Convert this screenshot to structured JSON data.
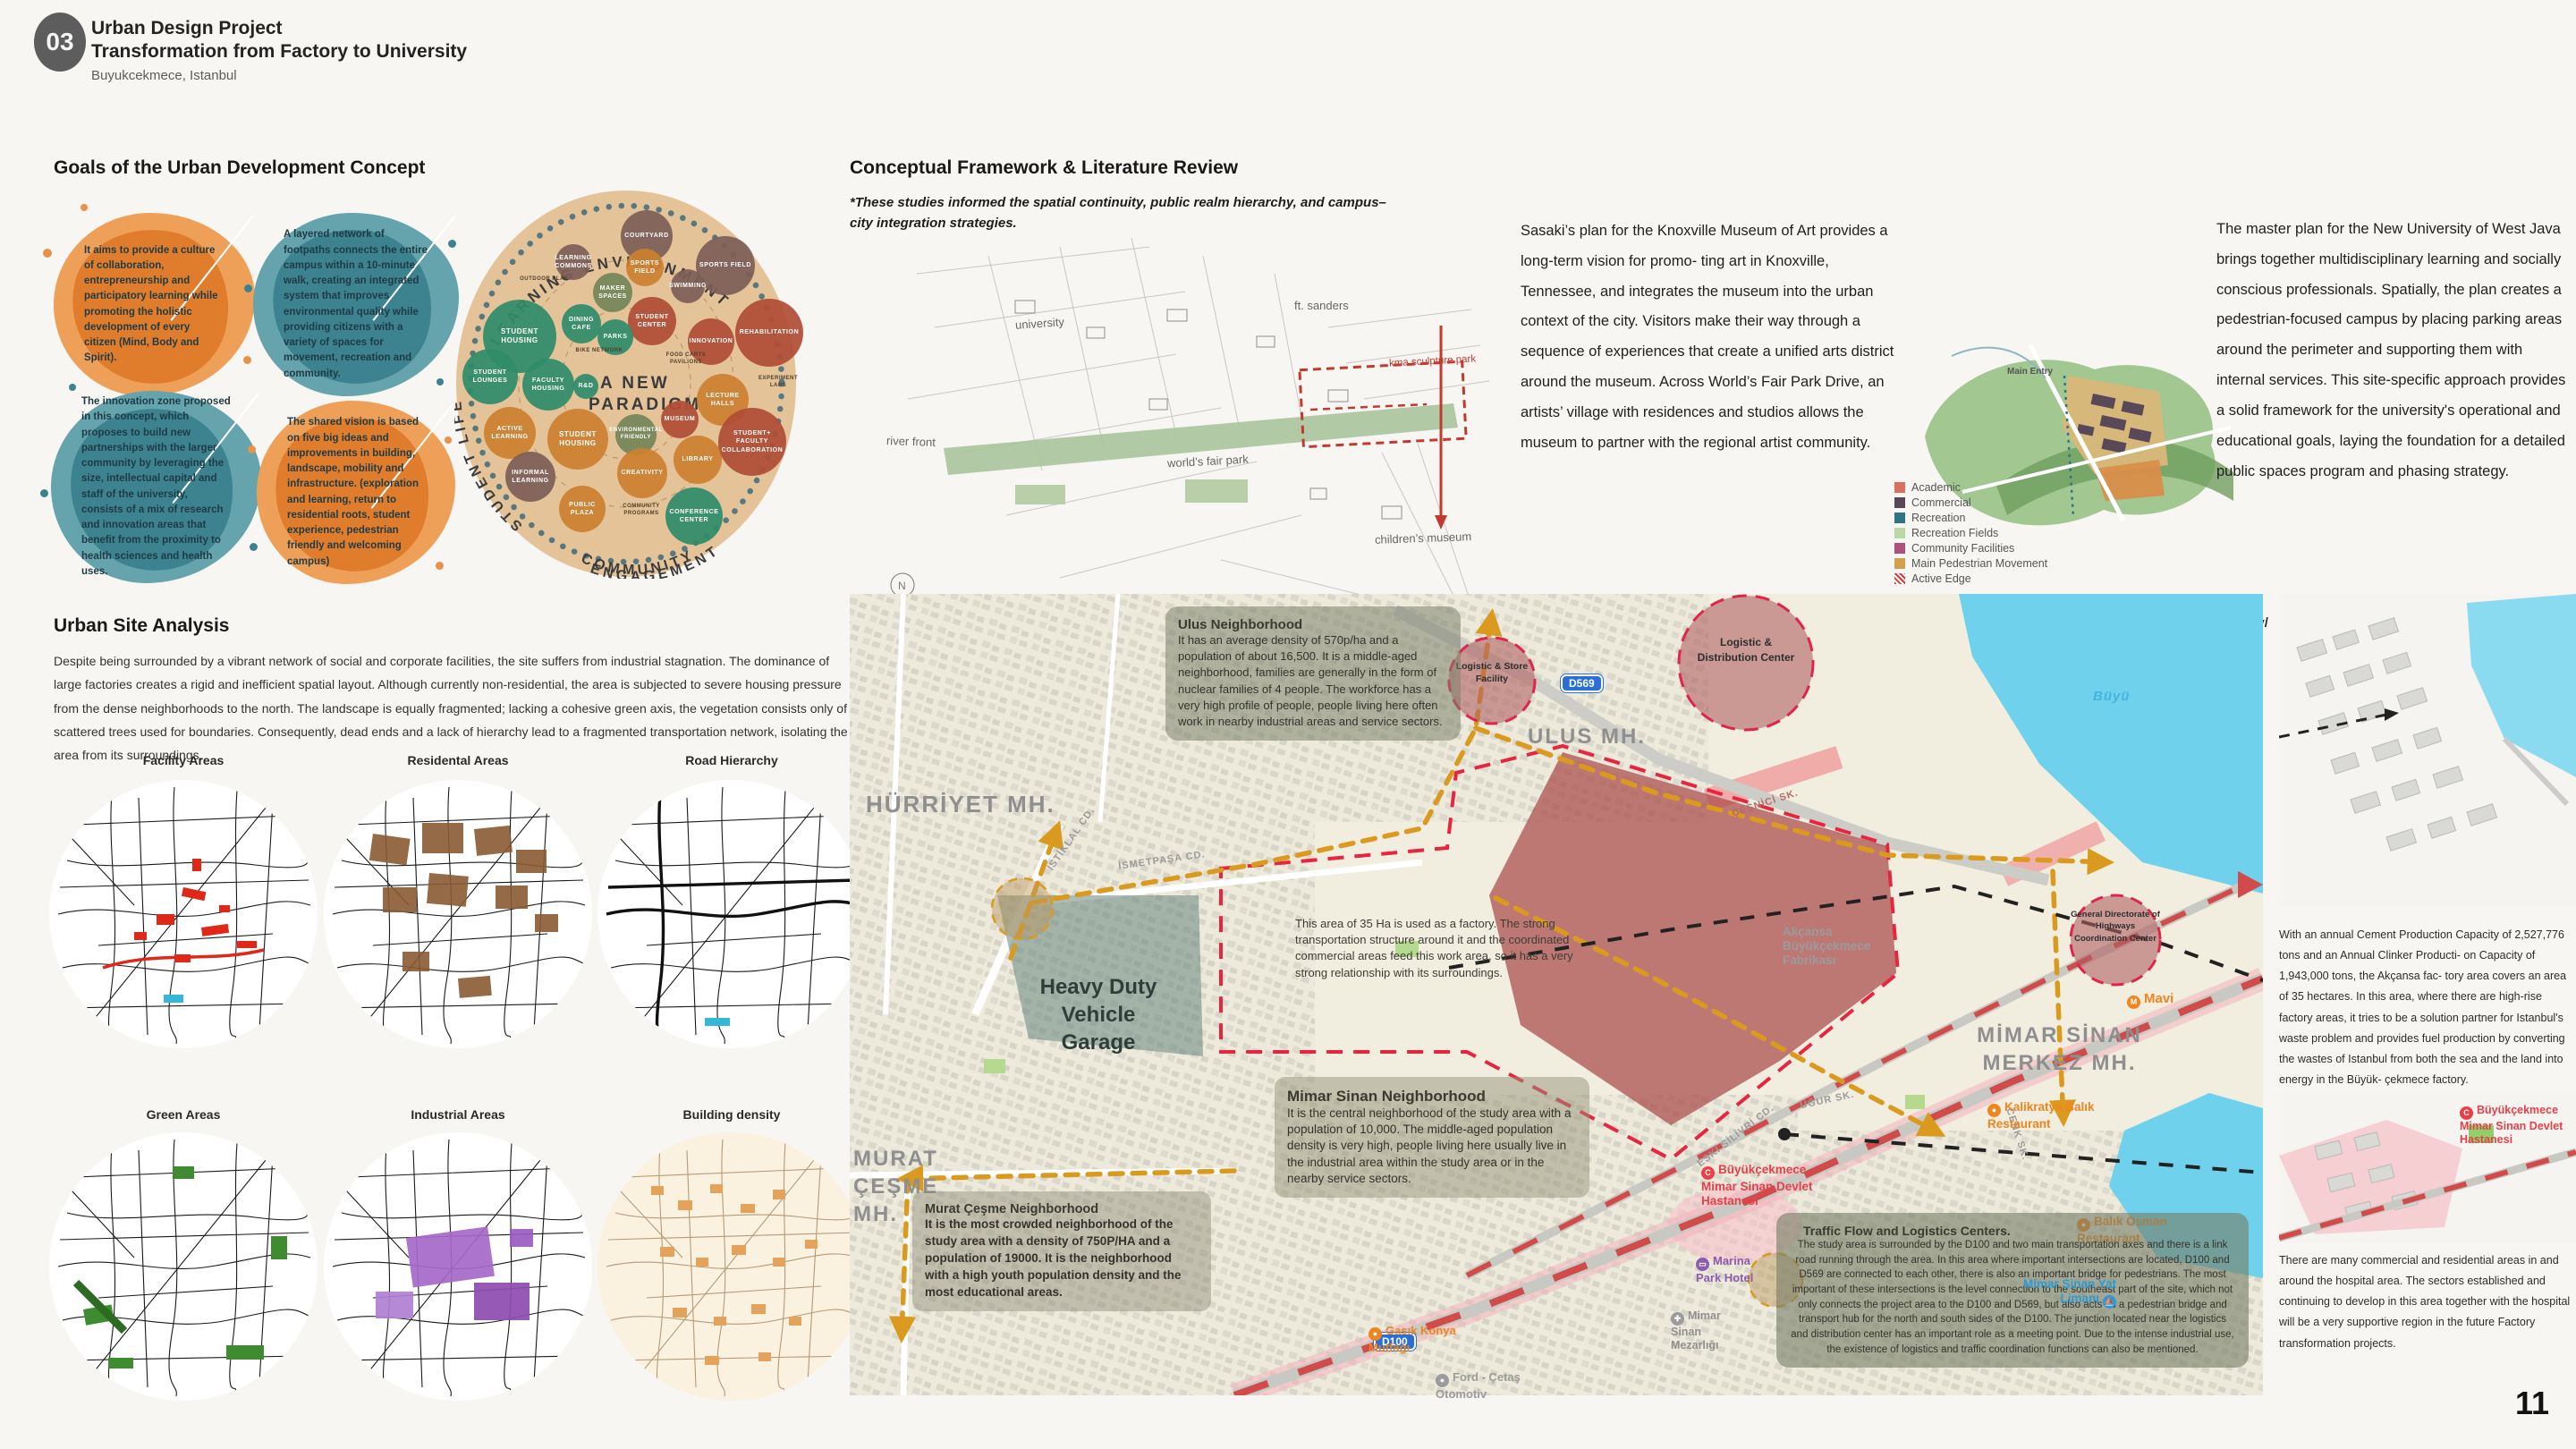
{
  "page": {
    "number": "11"
  },
  "header": {
    "badge": "03",
    "title_line1": "Urban Design Project",
    "title_line2": "Transformation from Factory to University",
    "subtitle": "Buyukcekmece, Istanbul"
  },
  "goals": {
    "heading": "Goals of the Urban Development Concept",
    "blobs": [
      {
        "text": "It aims to provide a culture of collaboration, entrepreneurship and participatory learning while promoting the holistic development of every citizen (Mind, Body and Spirit)."
      },
      {
        "text": "A layered network of footpaths connects the entire campus within a 10-minute walk, creating an integrated system that improves environmental quality while providing citizens with a variety of spaces for movement, recreation and community."
      },
      {
        "text": "The innovation zone proposed in this concept, which proposes to build new partnerships with the larger community by leveraging the size, intellectual capital and staff of the university, consists of a mix of research and innovation areas that benefit from the proximity to health sciences and health uses."
      },
      {
        "text": "The shared vision is based on five big ideas and improvements in building, landscape, mobility and infrastructure. (exploration and learning, return to residential roots, student experience, pedestrian friendly and welcoming campus)"
      }
    ]
  },
  "paradigm": {
    "arc_top": "LEARNING ENVIRONMENT",
    "arc_left": "STUDENT LIFE",
    "arc_bottom_1": "COMMUNITY",
    "arc_bottom_2": "ENGAGEMENT",
    "center_1": "A NEW",
    "center_2": "PARADIGM",
    "bubbles": [
      "COURTYARD",
      "LEARNING COMMONS",
      "SPORTS FIELD",
      "SPORTS FIELD",
      "SWIMMING",
      "MAKER SPACES",
      "STUDENT CENTER",
      "INNOVATION",
      "REHABILITATION",
      "DINING CAFE",
      "PARKS",
      "STUDENT HOUSING",
      "STUDENT LOUNGES",
      "FACULTY HOUSING",
      "R&D",
      "ACTIVE LEARNING",
      "STUDENT HOUSING",
      "ENVIRONMENTAL FRIENDLY",
      "MUSEUM",
      "LECTURE HALLS",
      "LIBRARY",
      "STUDENT+ FACULTY COLLABORATION",
      "INFORMAL LEARNING",
      "CREATIVITY",
      "PUBLIC PLAZA",
      "CONFERENCE CENTER"
    ],
    "notes": [
      "OUTDOOR PLAY",
      "BIKE NETWORK",
      "FOOD CARTS PAVILIONS",
      "EXPERIMENT LABS",
      "COMMUNITY PROGRAMS"
    ]
  },
  "site": {
    "heading": "Urban Site Analysis",
    "paragraph": "Despite being surrounded by a vibrant network of social and corporate facilities, the site suffers from industrial stagnation. The dominance of large factories creates a rigid and inefficient spatial layout. Although currently non-residential, the area is subjected to severe housing pressure from the dense neighborhoods to the north. The landscape is equally fragmented; lacking a cohesive green axis, the vegetation consists only of scattered trees used for boundaries. Consequently, dead ends and a lack of hierarchy lead to a fragmented transportation network, isolating the area from its surroundings.",
    "thumbnails": [
      "Facility Areas",
      "Residental Areas",
      "Road Hierarchy",
      "Green Areas",
      "Industrial Areas",
      "Building density"
    ]
  },
  "framework": {
    "heading": "Conceptual Framework & Literature Review",
    "note": "*These studies informed the spatial continuity, public realm hierarchy, and campus–city integration strategies.",
    "knoxville_labels": [
      "university",
      "ft. sanders",
      "river front",
      "world’s fair park",
      "kma sculpture park",
      "children’s museum",
      "downtown"
    ],
    "sasaki_paragraph": "Sasaki’s plan for the Knoxville Museum of Art provides a long-term vision for promo- ting art in Knoxville, Tennessee, and integrates the museum into the urban context of the city. Visitors make their way through a sequence of experiences that create a unified arts district around the museum. Across World’s Fair Park Drive, an artists’ village with residences and studios allows the museum to partner with the regional artist community.",
    "westjava_paragraph": "The master plan for the New University of West Java brings together multidisciplinary learning and socially conscious professionals. Spatially, the plan creates a pedestrian-focused campus by placing parking areas around the perimeter and supporting them with internal services. This site-specific approach provides a solid framework for the university's operational and educational goals, laying the foundation for a detailed public spaces program and phasing strategy.",
    "url": "https://www.sasaki.com/projects/west-java-new-university/",
    "legend": [
      "Academic",
      "Commercial",
      "Recreation",
      "Recreation Fields",
      "Community Facilities",
      "Main Pedestrian Movement",
      "Active Edge"
    ],
    "main_entry": "Main Entry"
  },
  "map": {
    "districts": {
      "hurriyet": "HÜRRİYET MH.",
      "ulus": "ULUS MH.",
      "murat": "MURAT ÇEŞME MH.",
      "mimar": "MİMAR SİNAN MERKEZ MH."
    },
    "badges": {
      "d569": "D569",
      "d100": "D100"
    },
    "streets": [
      "İSTİKLAL CD.",
      "İSMETPAŞA CD.",
      "ÇEŞNİCİ SK.",
      "UĞUR SK.",
      "ESKİ SİLİVRİ CD.",
      "CENK SK."
    ],
    "water_label": "Büyü",
    "zones": {
      "store": "Logistic & Store Facility",
      "dist": "Logistic & Distribution Center",
      "highways": "General Directorate of Highways Coordination Center",
      "garage": "Heavy Duty Vehicle Garage"
    },
    "annotations": {
      "ulus_title": "Ulus Neighborhood",
      "ulus_body": "It has an average density of 570p/ha and a population of about 16,500. It is a middle-aged neighborhood, families are generally in the form of nuclear families of 4 people. The workforce has a very high profile of people, people living here often work in nearby industrial areas and service sectors.",
      "factory_body": "This area of 35 Ha is used as a factory. The strong transportation structure around it and the coordinated commercial areas feed this work area, so it has a very strong relationship with its surroundings.",
      "mimar_title": "Mimar Sinan Neighborhood",
      "mimar_body": "It is the central neighborhood of the study area with a population of 10,000. The middle-aged population density is very high, people living here usually live in the industrial area within the study area or in the nearby service sectors.",
      "murat_title": "Murat Çeşme Neighborhood",
      "murat_body": "It is the most crowded neighborhood of the study area with a density of 750P/HA and a population of 19000. It is the neighborhood with a high youth population density and the most educational areas.",
      "traffic_title": "Traffic Flow and Logistics Centers.",
      "traffic_body": "The study area is surrounded by the D100 and two main transportation axes and there is a link road running through the area. In this area where important intersections are located, D100 and D569 are connected to each other, there is also an important bridge for pedestrians. The most important of these intersections is the level connection to the southeast part of the site, which not only connects the project area to the D100 and D569, but also acts as a pedestrian bridge and transport hub for the north and south sides of the D100. The junction located near the logistics and distribution center has an important role as a meeting point. Due to the intense industrial use, the existence of logistics and traffic coordination functions can also be mentioned."
    },
    "pois": {
      "akcansa": "Akçansa Büyükçekmece Fabrikası",
      "mavi": "Mavi",
      "kalikratya": "Kalikratya Balık Restaurant",
      "hospital": "Büyükçekmece Mimar Sinan Devlet Hastanesi",
      "marina": "Marina Park Hotel",
      "yat": "Mimar Sinan Yat Limanı",
      "balik": "Balık Osman Restaurant",
      "mezarlik": "Mimar Sinan Mezarlığı",
      "gasik": "Gasık Konya Mutfağı",
      "ford": "Ford - Çetaş Otomotiv"
    }
  },
  "right": {
    "cement_paragraph": "With an annual Cement Production Capacity of 2,527,776 tons and an Annual Clinker Producti- on Capacity of 1,943,000 tons, the Akçansa fac- tory area covers an area of 35 hectares. In this area, where there are high-rise factory areas, it tries to be a solution partner for Istanbul's waste problem and provides fuel production by converting the wastes of Istanbul from both the sea and the land into energy in the Büyük- çekmece factory.",
    "hospital_label": "Büyükçekmece Mimar Sinan Devlet Hastanesi",
    "bottom_paragraph": "There are many commercial and residential areas in and around the hospital area. The sectors established and continuing to develop in this area together with the hospital will be a very supportive region in the future Factory transformation projects."
  },
  "colors": {
    "accent_gold": "#d99a1e",
    "accent_red": "#e0254a",
    "factory_fill": "#aa4b4b",
    "water": "#6fd1ec"
  }
}
